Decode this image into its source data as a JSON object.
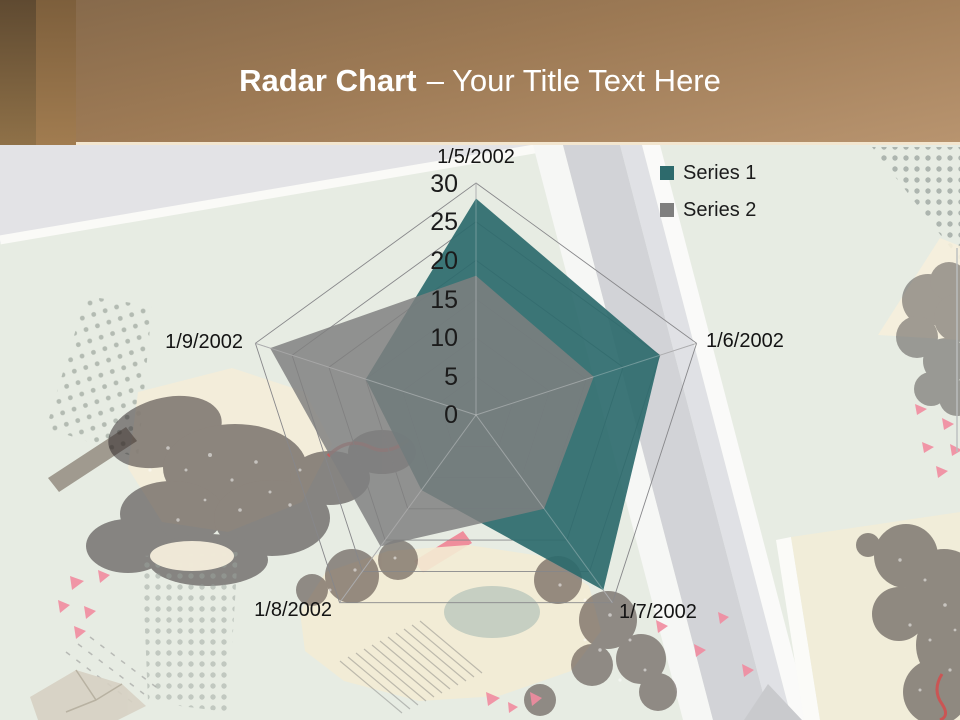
{
  "slide": {
    "title_bold": "Radar Chart",
    "title_rest": "– Your Title Text Here"
  },
  "legend": {
    "items": [
      {
        "label": "Series 1"
      },
      {
        "label": "Series 2"
      }
    ]
  },
  "chart_data": {
    "type": "radar",
    "categories": [
      "1/5/2002",
      "1/6/2002",
      "1/7/2002",
      "1/8/2002",
      "1/9/2002"
    ],
    "series": [
      {
        "name": "Series 1",
        "color": "#2d6a6c",
        "values": [
          28,
          25,
          28,
          12,
          15
        ]
      },
      {
        "name": "Series 2",
        "color": "#7f7f7f",
        "values": [
          18,
          16,
          15,
          21,
          28
        ]
      }
    ],
    "ticks": [
      0,
      5,
      10,
      15,
      20,
      25,
      30
    ],
    "axis_min": 0,
    "axis_max": 30,
    "grid": true,
    "legend_position": "top-right"
  },
  "colors": {
    "header_brown_dark": "#6a5236",
    "header_brown_light": "#b8946f",
    "header_edge_cream": "#f3e6cf",
    "background_green": "#e7ece3",
    "series1_teal": "#2d6a6c",
    "series2_gray": "#7f7f7f"
  }
}
